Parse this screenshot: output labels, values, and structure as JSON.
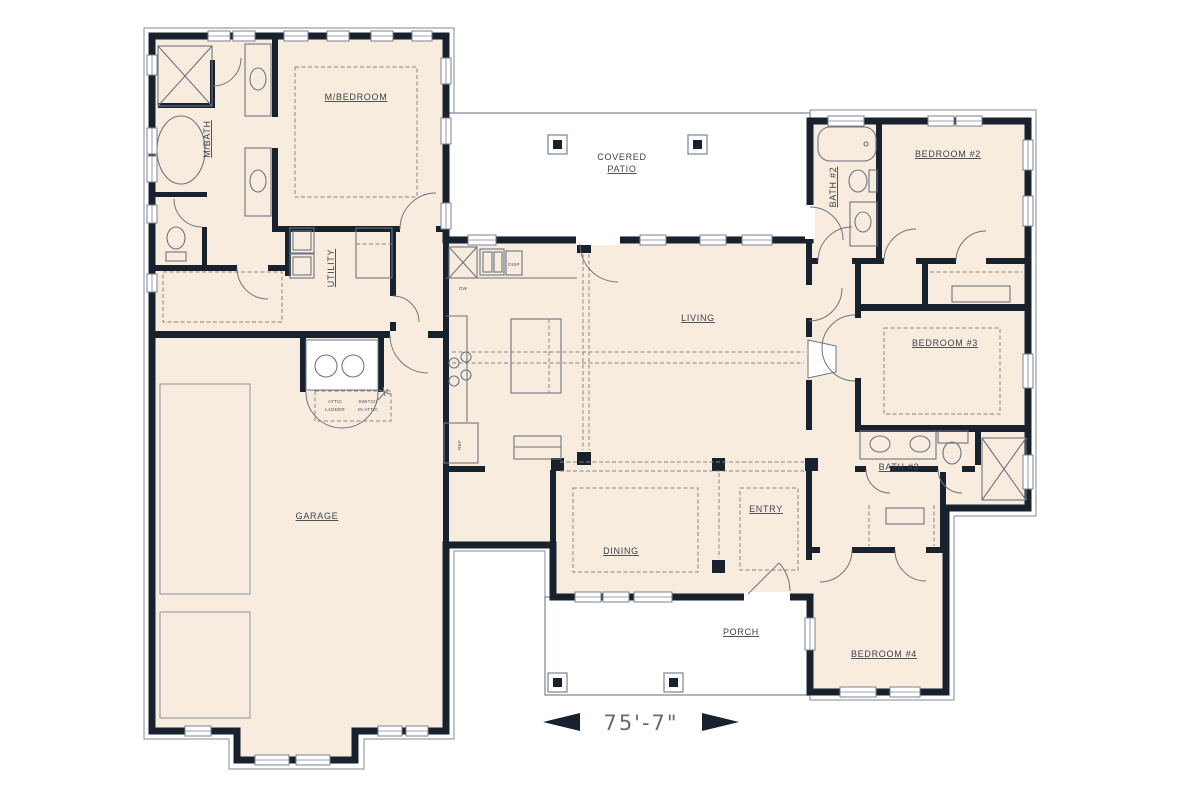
{
  "plan": {
    "rooms": {
      "master_bedroom": "M/BEDROOM",
      "master_bath": "M/BATH",
      "utility": "UTILITY",
      "covered_patio_line1": "COVERED",
      "covered_patio_line2": "PATIO",
      "living": "LIVING",
      "garage": "GARAGE",
      "dining": "DINING",
      "entry": "ENTRY",
      "porch": "PORCH",
      "bedroom2": "BEDROOM #2",
      "bath2": "BATH #2",
      "bedroom3": "BEDROOM #3",
      "bath3": "BATH #3",
      "bedroom4": "BEDROOM #4"
    },
    "fixtures": {
      "dishwasher": "DW",
      "disposal": "DISP",
      "refrigerator": "REF"
    },
    "annotations": {
      "attic_note_line1": "ATTIC",
      "attic_note_line2": "LADDER",
      "attic_note_line3": "SWITCH",
      "attic_note_line4": "IN ATTIC"
    },
    "dimension": {
      "overall_width": "75'-7\""
    },
    "colors": {
      "wall": "#18222f",
      "floor": "#f8ecdf",
      "outdoor": "#ffffff",
      "fixture_line": "#6d7480",
      "dashed_line": "#8d8378",
      "label_text": "#3d424a",
      "dimension_text": "#666b72"
    }
  }
}
